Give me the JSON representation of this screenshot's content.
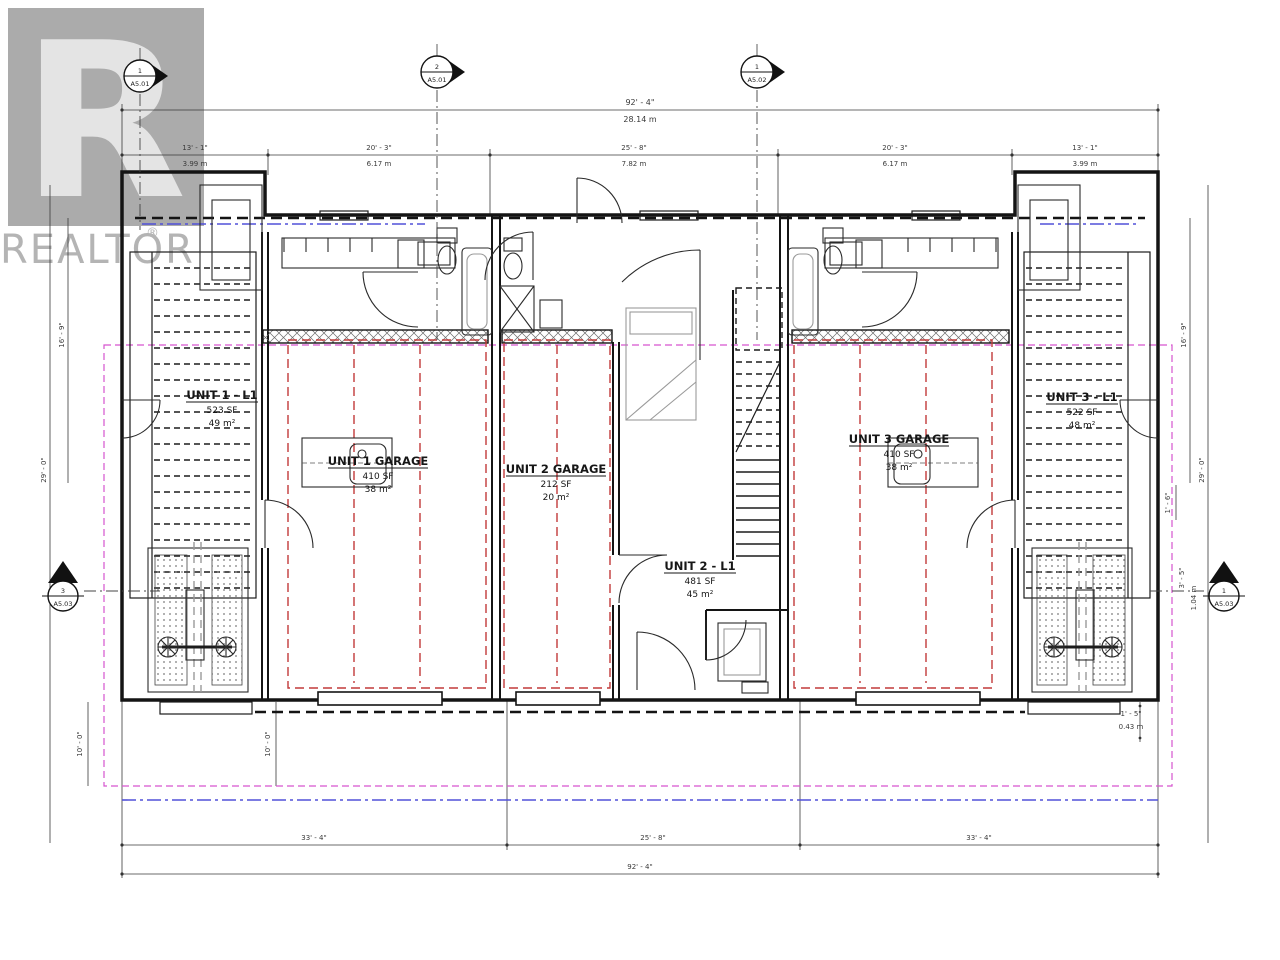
{
  "watermark": {
    "letter": "R",
    "name": "REALTOR",
    "registered": "®"
  },
  "units": [
    {
      "label": "UNIT 1 - L1",
      "area_sf": "523 SF",
      "area_m2": "49 m²",
      "garage_label": "UNIT 1 GARAGE",
      "garage_sf": "410 SF",
      "garage_m2": "38 m²"
    },
    {
      "label": "UNIT 2 - L1",
      "area_sf": "481 SF",
      "area_m2": "45 m²",
      "garage_label": "UNIT 2 GARAGE",
      "garage_sf": "212 SF",
      "garage_m2": "20 m²"
    },
    {
      "label": "UNIT 3 - L1",
      "area_sf": "522 SF",
      "area_m2": "48 m²",
      "garage_label": "UNIT 3 GARAGE",
      "garage_sf": "410 SF",
      "garage_m2": "38 m²"
    }
  ],
  "dimensions": {
    "top_overall": {
      "ft": "92' - 4\"",
      "m": "28.14 m"
    },
    "top_segments": [
      {
        "ft": "13' - 1\"",
        "m": "3.99 m"
      },
      {
        "ft": "20' - 3\"",
        "m": "6.17 m"
      },
      {
        "ft": "25' - 8\"",
        "m": "7.82 m"
      },
      {
        "ft": "20' - 3\"",
        "m": "6.17 m"
      },
      {
        "ft": "13' - 1\"",
        "m": "3.99 m"
      }
    ],
    "bottom_segments": [
      {
        "ft": "33' - 4\""
      },
      {
        "ft": "25' - 8\""
      },
      {
        "ft": "33' - 4\""
      }
    ],
    "bottom_overall": {
      "ft": "92' - 4\""
    },
    "left_outer": "29' - 0\"",
    "left_inner": "16' - 9\"",
    "right_outer": "29' - 0\"",
    "right_inner": "16' - 9\"",
    "right_step": "1' - 6\"",
    "right_offset_ft": "3' - 5\"",
    "right_offset_m": "1.04 m",
    "right_bottom_ft": "1' - 5\"",
    "right_bottom_m": "0.43 m",
    "left_bottom_1": "10' - 0\"",
    "left_bottom_2": "10' - 0\""
  },
  "section_markers": [
    {
      "number": "1",
      "sheet": "A5.01"
    },
    {
      "number": "2",
      "sheet": "A5.01"
    },
    {
      "number": "1",
      "sheet": "A5.02"
    },
    {
      "number": "3",
      "sheet": "A5.03"
    },
    {
      "number": "1",
      "sheet": "A5.03"
    }
  ],
  "colors": {
    "wall": "#141414",
    "garage_dashed_red": "#c23a3a",
    "property_magenta": "#d655cf",
    "reference_blue": "#5151d8",
    "watermark_gray": "#b4b4b4"
  }
}
